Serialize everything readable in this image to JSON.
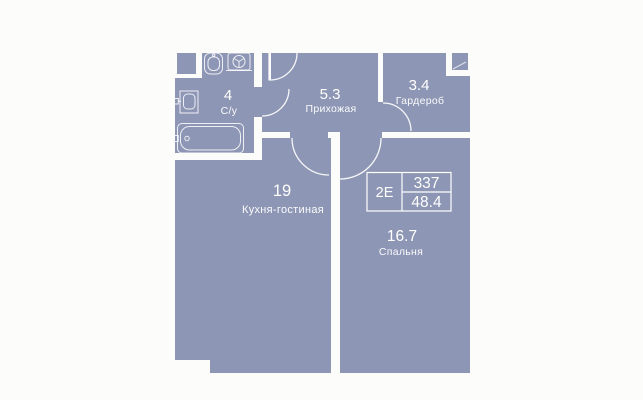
{
  "floor_plan": {
    "unit_info": {
      "layout_type": "2Е",
      "unit_number": "337",
      "total_area": "48.4"
    },
    "rooms": [
      {
        "area": "4",
        "name": "С/у"
      },
      {
        "area": "5.3",
        "name": "Прихожая"
      },
      {
        "area": "3.4",
        "name": "Гардероб"
      },
      {
        "area": "19",
        "name": "Кухня-гостиная"
      },
      {
        "area": "16.7",
        "name": "Спальня"
      }
    ],
    "fixtures": [
      "toilet-icon",
      "washing-machine-icon",
      "sink-icon",
      "bathtub-icon"
    ],
    "colors": {
      "room_fill": "#8d96b4",
      "background": "#fcfcfb",
      "lines": "#ffffff"
    }
  }
}
